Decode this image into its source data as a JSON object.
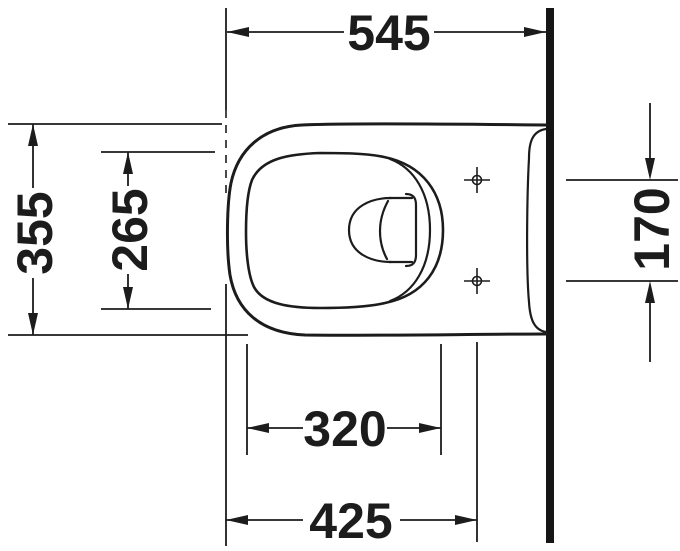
{
  "drawing": {
    "type": "technical-dimension-drawing",
    "subject": "wall-hung toilet, plan view (top), mounted against wall at right",
    "unit": "mm",
    "colors": {
      "line": "#1c1c1c",
      "wall": "#161616",
      "background": "#ffffff"
    },
    "dimensions": {
      "depth_total": "545",
      "width_total": "355",
      "bowl_inner_width": "265",
      "fixing_holes_spacing": "170",
      "bowl_inner_length": "320",
      "front_to_fixing_holes": "425"
    }
  }
}
